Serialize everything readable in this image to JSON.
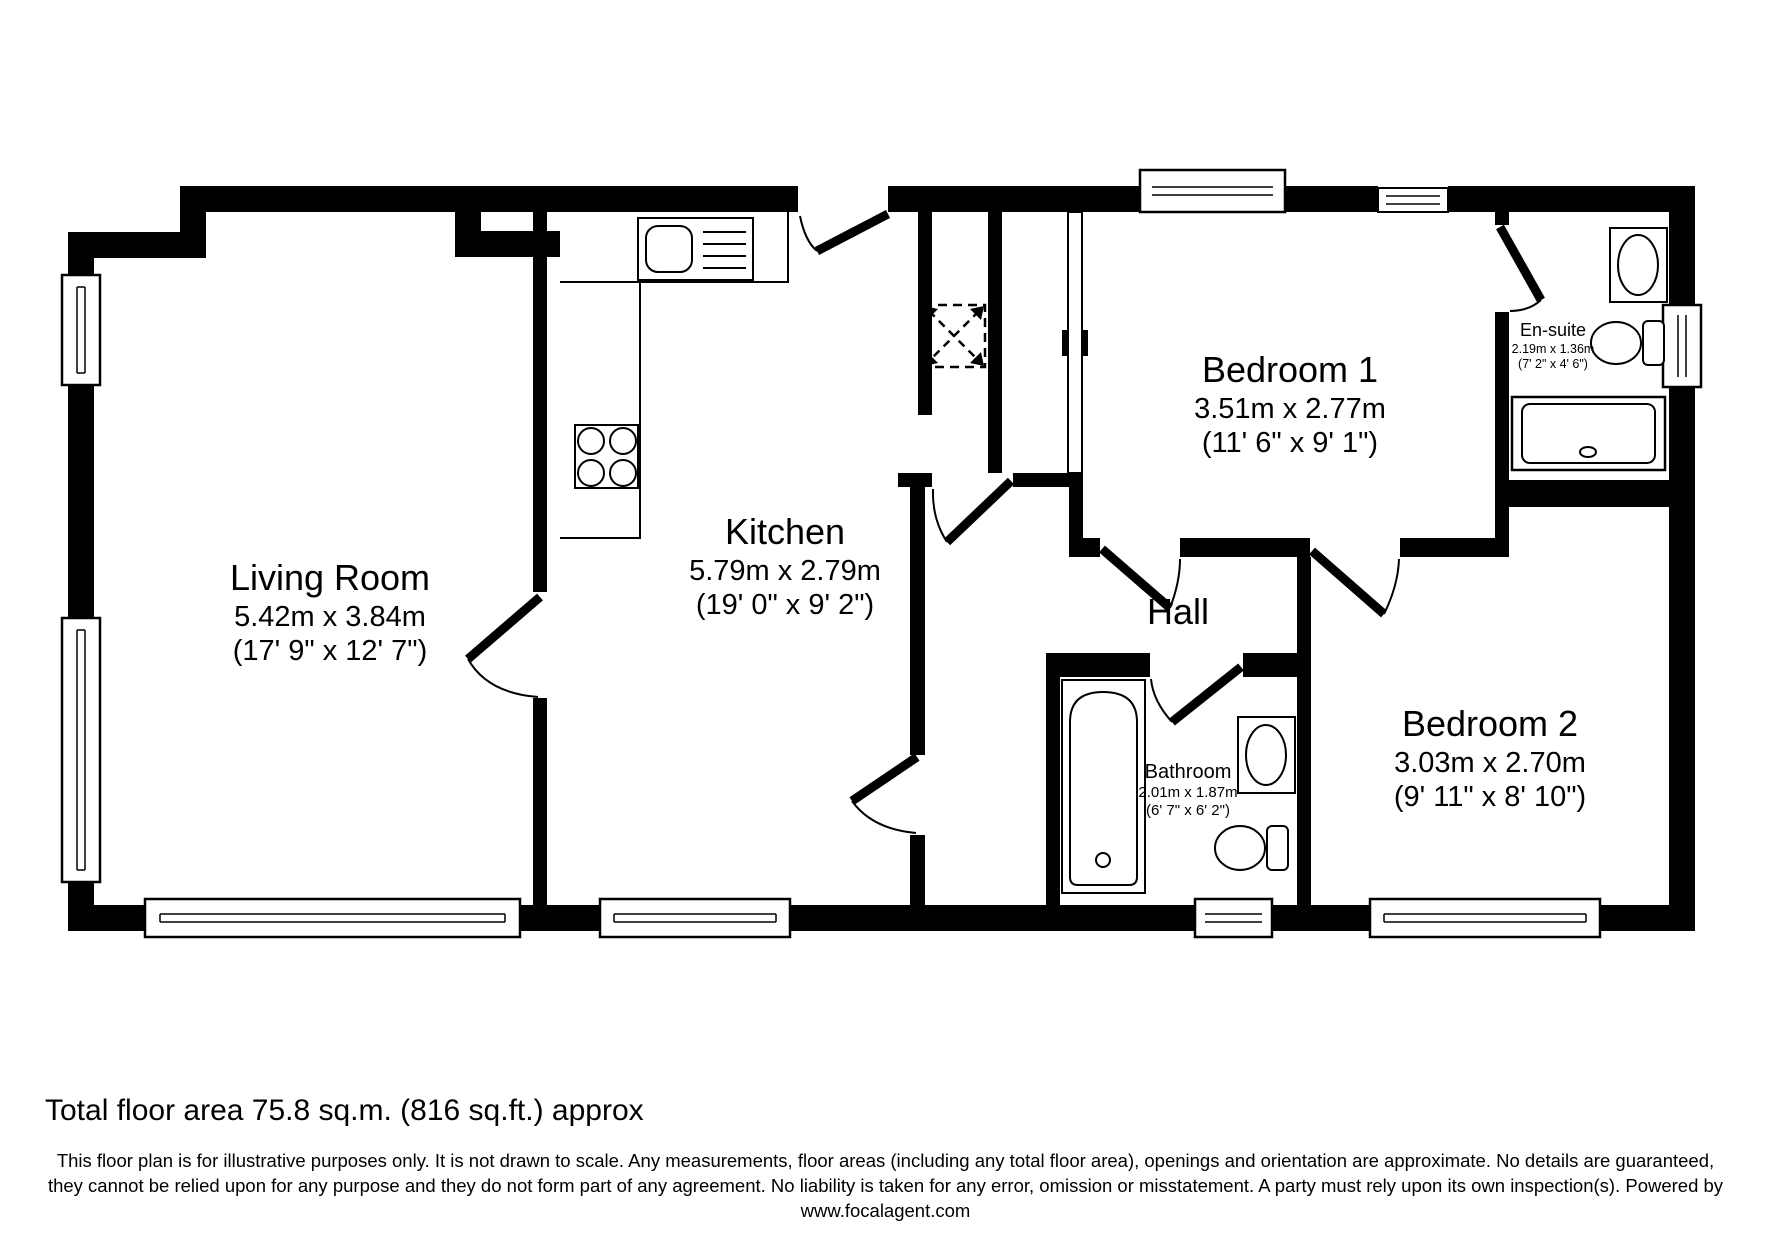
{
  "floor_plan": {
    "colors": {
      "wall": "#000000",
      "background": "#ffffff"
    },
    "rooms": [
      {
        "id": "living-room",
        "name": "Living Room",
        "metric": "5.42m x 3.84m",
        "imperial": "(17' 9\" x 12' 7\")"
      },
      {
        "id": "kitchen",
        "name": "Kitchen",
        "metric": "5.79m x 2.79m",
        "imperial": "(19' 0\" x 9' 2\")"
      },
      {
        "id": "hall",
        "name": "Hall",
        "metric": "",
        "imperial": ""
      },
      {
        "id": "bedroom-1",
        "name": "Bedroom 1",
        "metric": "3.51m x 2.77m",
        "imperial": "(11' 6\" x 9' 1\")"
      },
      {
        "id": "bedroom-2",
        "name": "Bedroom 2",
        "metric": "3.03m x 2.70m",
        "imperial": "(9' 11\" x 8' 10\")"
      },
      {
        "id": "bathroom",
        "name": "Bathroom",
        "metric": "2.01m x 1.87m",
        "imperial": "(6' 7\" x 6' 2\")"
      },
      {
        "id": "en-suite",
        "name": "En-suite",
        "metric": "2.19m x 1.36m",
        "imperial": "(7' 2\" x 4' 6\")"
      }
    ],
    "footer": {
      "total_area": "Total floor area 75.8 sq.m. (816 sq.ft.) approx",
      "disclaimer_line1": "This floor plan is for illustrative purposes only. It is not drawn to scale. Any measurements, floor areas (including any total floor area), openings and orientation are approximate. No details are guaranteed,",
      "disclaimer_line2": "they cannot be relied upon for any purpose and they do not form part of any agreement. No liability is taken for any error, omission or misstatement. A party must rely upon its own inspection(s).  Powered by",
      "website": "www.focalagent.com"
    }
  }
}
